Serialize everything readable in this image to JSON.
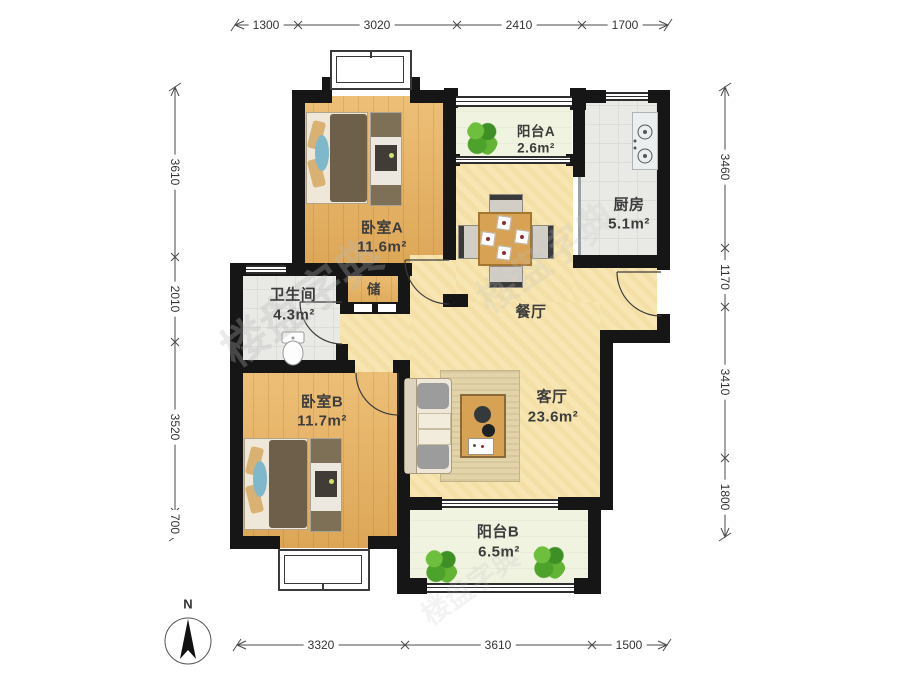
{
  "plan": {
    "compass_label": "N",
    "watermark": "楼盘字典",
    "rooms": [
      {
        "id": "bedroom-a",
        "name": "卧室A",
        "area": "11.6m²"
      },
      {
        "id": "balcony-a",
        "name": "阳台A",
        "area": "2.6m²"
      },
      {
        "id": "kitchen",
        "name": "厨房",
        "area": "5.1m²"
      },
      {
        "id": "bathroom",
        "name": "卫生间",
        "area": "4.3m²"
      },
      {
        "id": "storage",
        "name": "储",
        "area": ""
      },
      {
        "id": "dining",
        "name": "餐厅",
        "area": ""
      },
      {
        "id": "bedroom-b",
        "name": "卧室B",
        "area": "11.7m²"
      },
      {
        "id": "living",
        "name": "客厅",
        "area": "23.6m²"
      },
      {
        "id": "balcony-b",
        "name": "阳台B",
        "area": "6.5m²"
      }
    ],
    "dimensions": {
      "top": [
        "1300",
        "3020",
        "2410",
        "1700"
      ],
      "left": [
        "3610",
        "2010",
        "3520",
        "700"
      ],
      "right": [
        "3460",
        "1170",
        "3410",
        "1800"
      ],
      "bottom": [
        "3320",
        "3610",
        "1500"
      ]
    },
    "colors": {
      "wall": "#161616",
      "wood": "#e7b160",
      "pale": "#f7e6b2",
      "tile": "#e9e9e6",
      "balcony": "#eff3df",
      "table-wood": "#d7a254",
      "duvet": "#6e5f4b",
      "pillow": "#d8b173",
      "runner": "#7fb8ca",
      "rug": "#e2d3a9",
      "sofa": "#efe8d8",
      "cushion": "#9c9c9c",
      "dim-text": "#333333",
      "label-text": "#3c3c3c"
    }
  }
}
